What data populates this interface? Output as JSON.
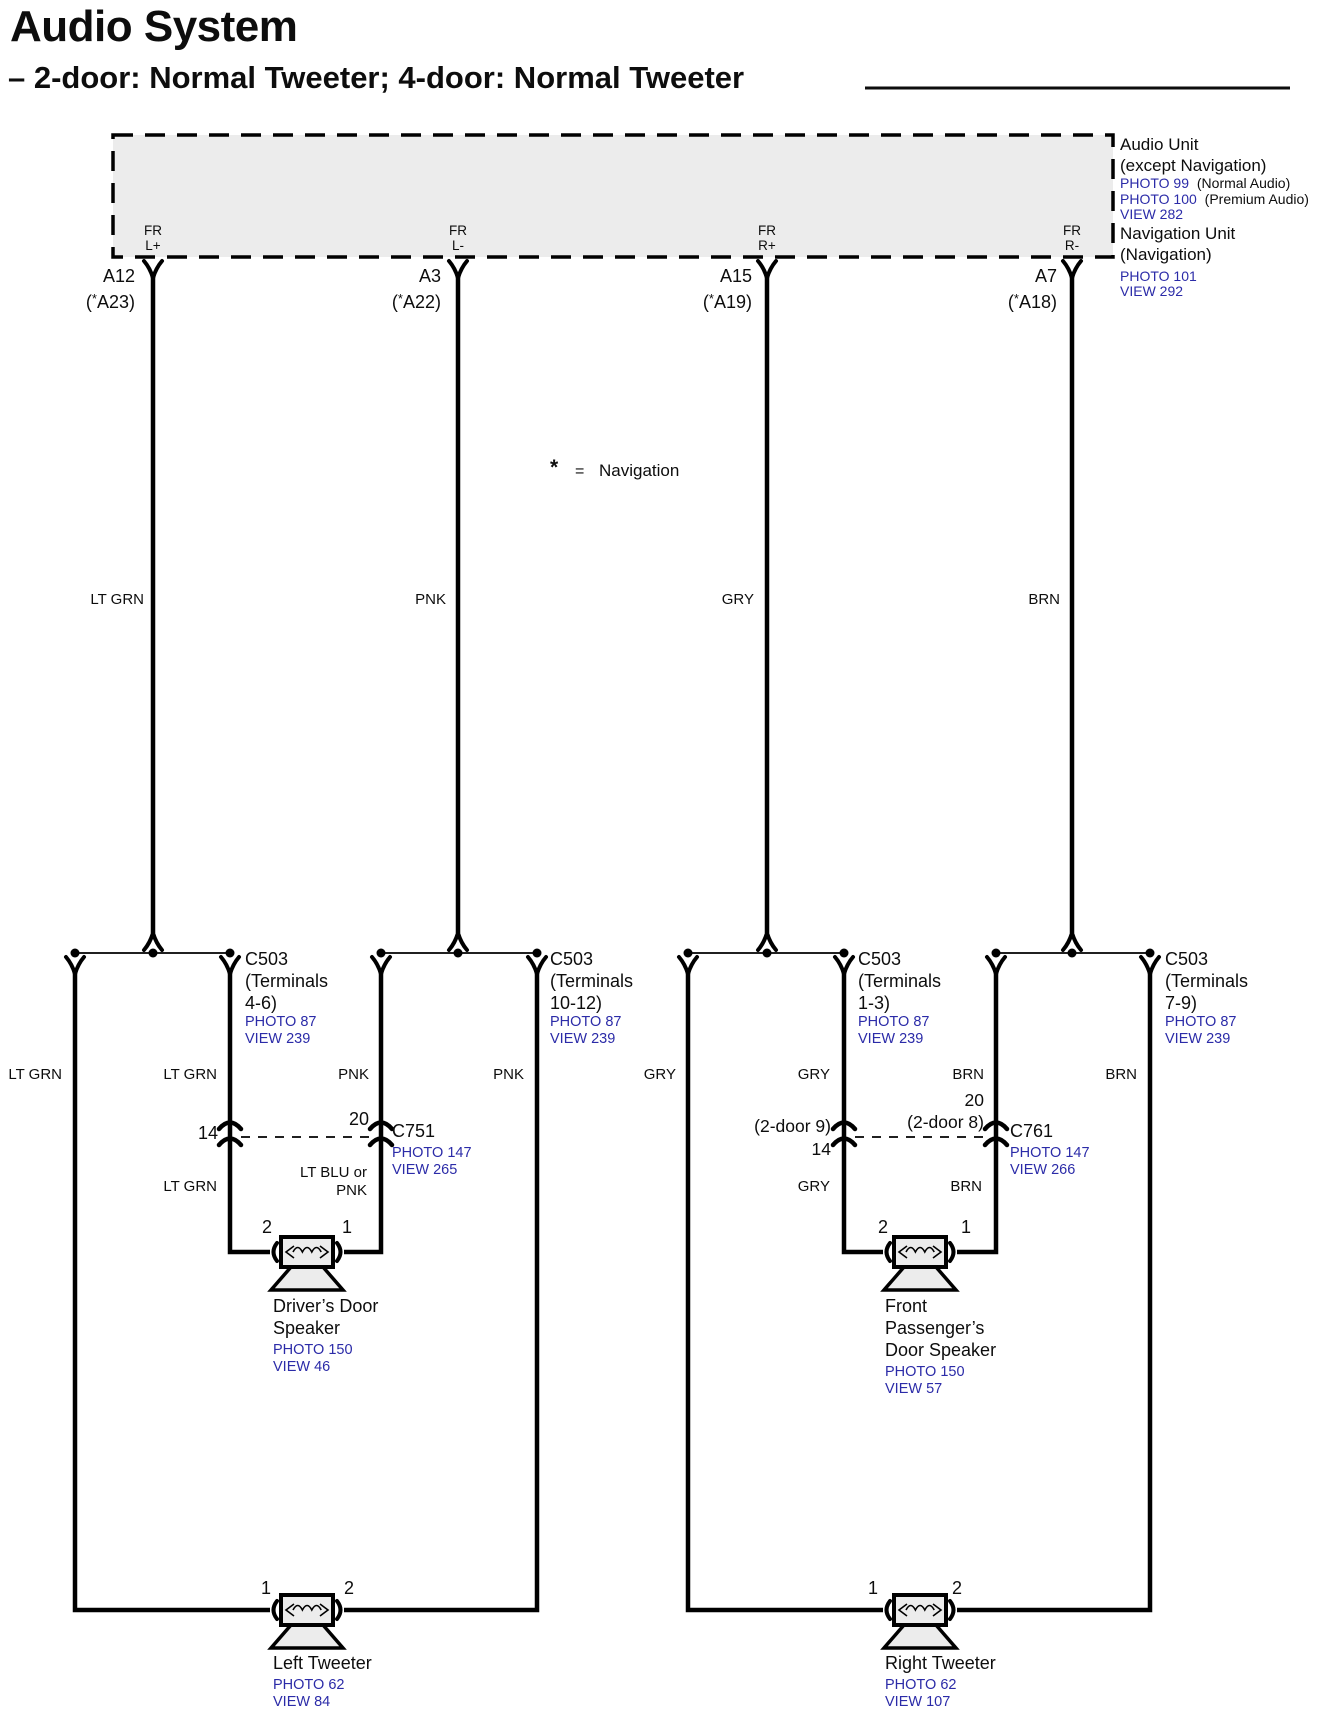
{
  "title": "Audio System",
  "subtitle": "– 2-door: Normal Tweeter; 4-door: Normal Tweeter",
  "note": {
    "star": "*",
    "equals": "=",
    "label": "Navigation"
  },
  "audio_unit": {
    "title": "Audio Unit",
    "subtitle": "(except Navigation)",
    "photo_normal": "PHOTO 99",
    "photo_normal_note": "(Normal Audio)",
    "photo_premium": "PHOTO 100",
    "photo_premium_note": "(Premium Audio)",
    "view": "VIEW 282",
    "nav_title": "Navigation Unit",
    "nav_subtitle": "(Navigation)",
    "nav_photo": "PHOTO 101",
    "nav_view": "VIEW 292"
  },
  "pins": [
    {
      "fr": "FR",
      "channel": "L+",
      "pin": "A12",
      "alt_pre": "(",
      "alt_star": "*",
      "alt_post": "A23)",
      "wire_color": "LT GRN"
    },
    {
      "fr": "FR",
      "channel": "L-",
      "pin": "A3",
      "alt_pre": "(",
      "alt_star": "*",
      "alt_post": "A22)",
      "wire_color": "PNK"
    },
    {
      "fr": "FR",
      "channel": "R+",
      "pin": "A15",
      "alt_pre": "(",
      "alt_star": "*",
      "alt_post": "A19)",
      "wire_color": "GRY"
    },
    {
      "fr": "FR",
      "channel": "R-",
      "pin": "A7",
      "alt_pre": "(",
      "alt_star": "*",
      "alt_post": "A18)",
      "wire_color": "BRN"
    }
  ],
  "c503": [
    {
      "name": "C503",
      "line2": "(Terminals",
      "line3": "4-6)",
      "photo": "PHOTO 87",
      "view": "VIEW 239"
    },
    {
      "name": "C503",
      "line2": "(Terminals",
      "line3": "10-12)",
      "photo": "PHOTO 87",
      "view": "VIEW 239"
    },
    {
      "name": "C503",
      "line2": "(Terminals",
      "line3": "1-3)",
      "photo": "PHOTO 87",
      "view": "VIEW 239"
    },
    {
      "name": "C503",
      "line2": "(Terminals",
      "line3": "7-9)",
      "photo": "PHOTO 87",
      "view": "VIEW 239"
    }
  ],
  "branch_wire_labels": [
    "LT GRN",
    "LT GRN",
    "PNK",
    "PNK",
    "GRY",
    "GRY",
    "BRN",
    "BRN"
  ],
  "c751": {
    "name": "C751",
    "photo": "PHOTO 147",
    "view": "VIEW 265",
    "term_left": "14",
    "term_right": "20",
    "wire_left": "LT GRN",
    "wire_right_line1": "LT BLU or",
    "wire_right_line2": "PNK"
  },
  "c761": {
    "name": "C761",
    "photo": "PHOTO 147",
    "view": "VIEW 266",
    "term_left_line1": "(2-door 9)",
    "term_left_line2": "14",
    "term_right_line1": "20",
    "term_right_line2": "(2-door 8)",
    "wire_left": "GRY",
    "wire_right": "BRN"
  },
  "speakers": {
    "driver": {
      "t_left": "2",
      "t_right": "1",
      "line1": "Driver’s Door",
      "line2": "Speaker",
      "photo": "PHOTO 150",
      "view": "VIEW 46"
    },
    "passenger": {
      "t_left": "2",
      "t_right": "1",
      "line1": "Front",
      "line2": "Passenger’s",
      "line3": "Door Speaker",
      "photo": "PHOTO 150",
      "view": "VIEW 57"
    },
    "left_tweeter": {
      "t_left": "1",
      "t_right": "2",
      "line1": "Left Tweeter",
      "photo": "PHOTO 62",
      "view": "VIEW 84"
    },
    "right_tweeter": {
      "t_left": "1",
      "t_right": "2",
      "line1": "Right Tweeter",
      "photo": "PHOTO 62",
      "view": "VIEW 107"
    }
  }
}
